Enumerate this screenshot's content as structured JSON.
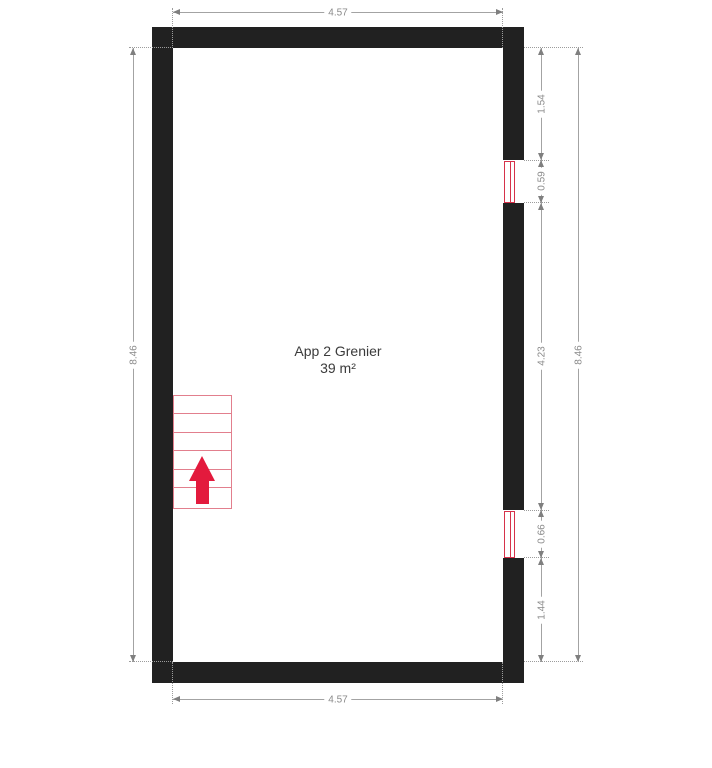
{
  "room": {
    "name": "App 2 Grenier",
    "area": "39 m²"
  },
  "dimensions": {
    "top_width": "4.57",
    "bottom_width": "4.57",
    "left_height": "8.46",
    "right_height": "8.46",
    "right_chain": [
      "1.54",
      "0.59",
      "4.23",
      "0.66",
      "1.44"
    ]
  },
  "icons": {
    "stair_arrow": "up-arrow"
  },
  "colors": {
    "wall": "#212121",
    "stair_outline": "#e27f8d",
    "stair_arrow": "#e31a3d",
    "window": "#d6324a",
    "dimension_line": "#a3a3a3",
    "dimension_text": "#8a8a8a",
    "room_text": "#3b3b3b"
  }
}
